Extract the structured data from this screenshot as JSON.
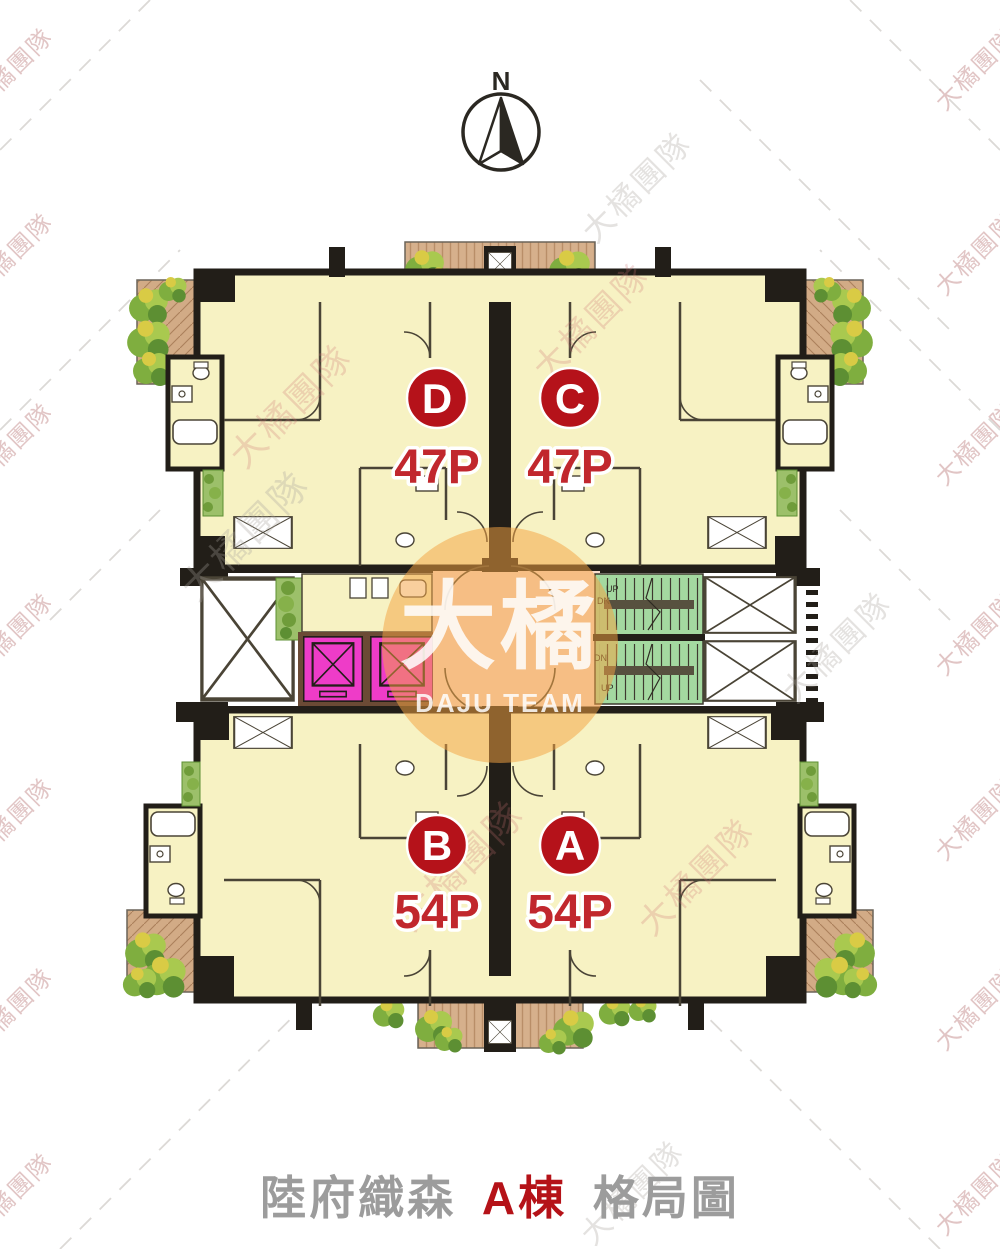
{
  "compass": {
    "label": "N"
  },
  "plan": {
    "units": [
      {
        "id": "D",
        "size": "47P"
      },
      {
        "id": "C",
        "size": "47P"
      },
      {
        "id": "B",
        "size": "54P"
      },
      {
        "id": "A",
        "size": "54P"
      }
    ],
    "stair_labels": {
      "up": "UP",
      "down": "DN"
    }
  },
  "watermark": {
    "edge_text": "大橘團隊",
    "center_main": "大橘",
    "center_sub": "DAJU TEAM"
  },
  "title": {
    "project": "陸府織森",
    "building": "A棟",
    "suffix": "格局圖"
  },
  "colors": {
    "unit_badge": "#b5121a",
    "size_text": "#c1272d",
    "room_fill": "#f7f2c3",
    "wall": "#221e18",
    "elevator": "#ee3cc8",
    "stairs": "#a4d9a0",
    "corridor": "#f8dcca",
    "deck_wood": "#d2ab86",
    "plant_green": "#7fae3f",
    "watermark_orange": "#f4a344",
    "title_gray": "#9c9c9c",
    "title_red": "#b51218"
  }
}
